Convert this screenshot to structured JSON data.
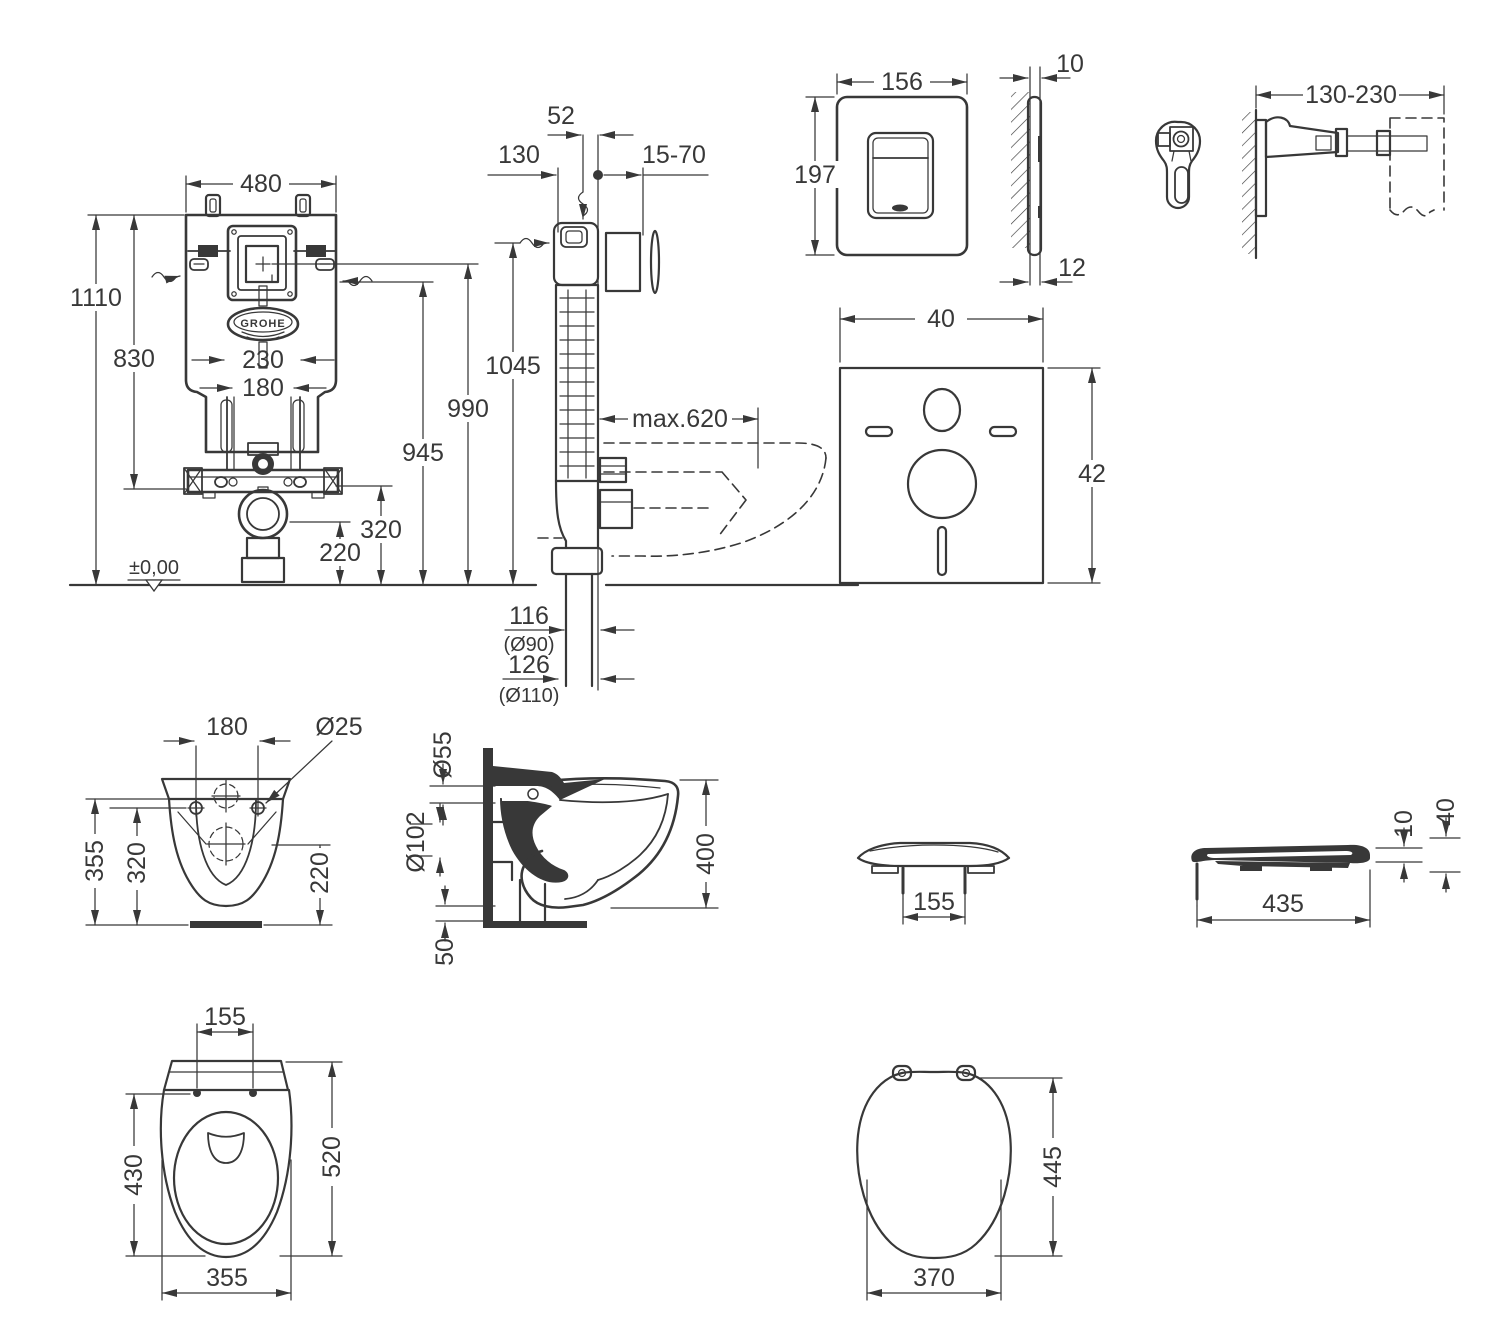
{
  "document": {
    "type": "technical-installation-drawing",
    "subject": "wall-hung WC with concealed cistern, flush plate, brackets, sound insulation pad and seat",
    "units": "mm",
    "ink_color": "#383838",
    "paper_color": "#ffffff"
  },
  "figures": {
    "cistern_front": {
      "w": "480",
      "h_total": "1110",
      "h_frame": "830",
      "c230": "230",
      "c180": "180",
      "h220": "220",
      "h320": "320",
      "h990": "990",
      "h945": "945",
      "ground": "±0,00",
      "brand": "GROHE"
    },
    "cistern_side": {
      "d52": "52",
      "d130": "130",
      "d15_70": "15-70",
      "h1045": "1045",
      "max620": "max.620",
      "n116": "116",
      "d90": "(Ø90)",
      "n126": "126",
      "d110": "(Ø110)"
    },
    "plate": {
      "w": "156",
      "h": "197",
      "t_top": "10",
      "t_bottom": "12"
    },
    "bracket": {
      "range": "130-230"
    },
    "pad": {
      "w": "40",
      "h": "42"
    },
    "bowl_rear": {
      "c180": "180",
      "hole": "Ø25",
      "h355": "355",
      "h320": "320",
      "h220": "220"
    },
    "bowl_side": {
      "inlet": "Ø55",
      "outlet": "Ø102",
      "h400": "400",
      "gap50": "50"
    },
    "seat_front": {
      "pins": "155"
    },
    "seat_side": {
      "len": "435",
      "t10": "10",
      "t40": "40"
    },
    "bowl_top": {
      "pins": "155",
      "inner": "430",
      "len": "520",
      "width": "355"
    },
    "seat_top": {
      "width": "370",
      "len": "445"
    }
  }
}
